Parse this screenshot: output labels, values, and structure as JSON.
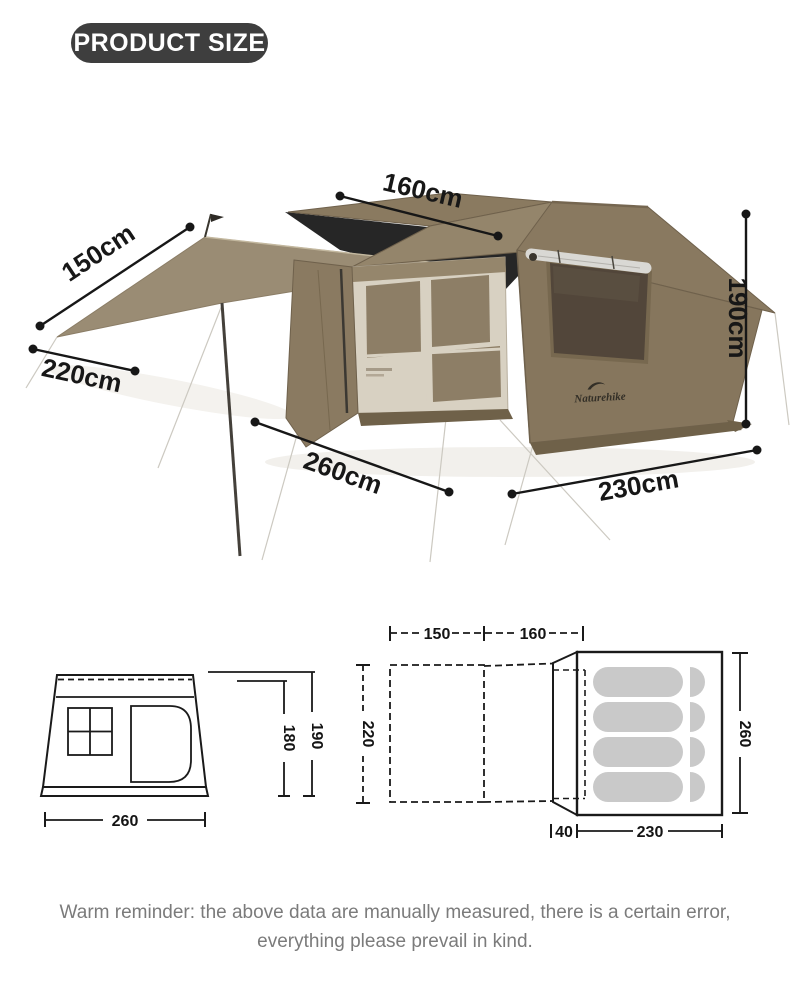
{
  "badge": {
    "label": "PRODUCT SIZE"
  },
  "photo": {
    "brand": "Naturehike",
    "dimensions": {
      "tarp_length": "150cm",
      "tarp_width": "220cm",
      "roof_width": "160cm",
      "height": "190cm",
      "depth": "260cm",
      "width": "230cm"
    }
  },
  "diagrams": {
    "front_view": {
      "width": "260",
      "inner_height": "180",
      "outer_height": "190"
    },
    "top_view": {
      "awning_length": "150",
      "roof_length": "160",
      "awning_width": "220"
    },
    "floor_plan": {
      "vestibule_depth": "40",
      "floor_width": "230",
      "floor_length": "260",
      "sleeping_pads": 4
    }
  },
  "footer": {
    "line1": "Warm reminder: the above data are manually measured, there is a certain error,",
    "line2": "everything please prevail in kind."
  },
  "colors": {
    "badge_bg": "#3e3e3e",
    "dimension_line": "#171717",
    "tent_khaki": "#8a7a60",
    "tent_dark_skirt": "#6f6149",
    "front_wall_cream": "#d8d1c2",
    "mesh_tan": "#8d7e66",
    "canopy_black": "#262626",
    "tarp": "#9a8c74",
    "pad_gray": "#c9c9c9",
    "footer_gray": "#7b7b7b"
  }
}
